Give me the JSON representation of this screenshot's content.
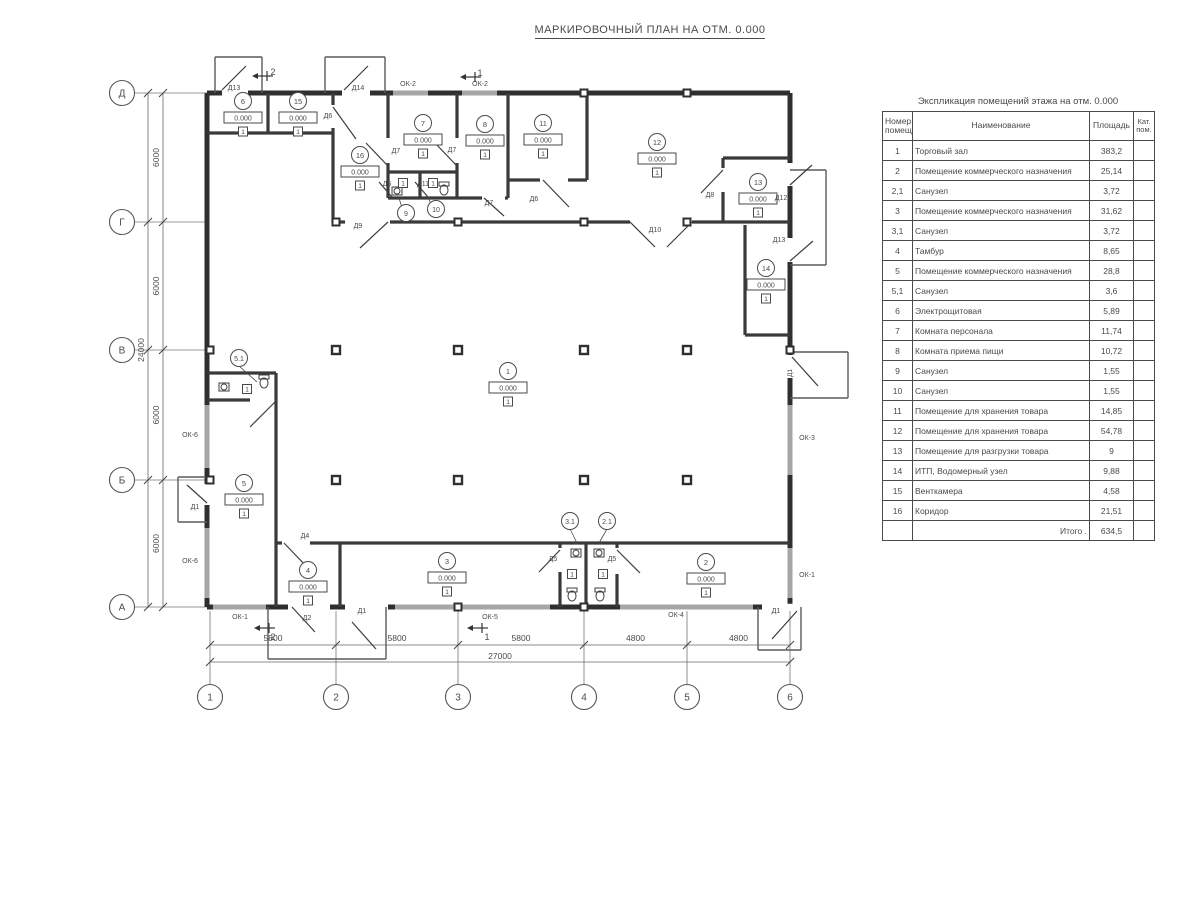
{
  "title": "МАРКИРОВОЧНЫЙ ПЛАН НА ОТМ. 0.000",
  "colors": {
    "wall": "#2f2f2f",
    "partition": "#3a3a3a",
    "window": "#a6a6a6",
    "thin": "#5a5a5a",
    "text": "#4a4a4a"
  },
  "plan": {
    "grid_rows": [
      {
        "label": "Д",
        "y": 93
      },
      {
        "label": "Г",
        "y": 222
      },
      {
        "label": "В",
        "y": 350
      },
      {
        "label": "Б",
        "y": 480
      },
      {
        "label": "А",
        "y": 607
      }
    ],
    "grid_cols": [
      {
        "label": "1",
        "x": 210
      },
      {
        "label": "2",
        "x": 336
      },
      {
        "label": "3",
        "x": 458
      },
      {
        "label": "4",
        "x": 584
      },
      {
        "label": "5",
        "x": 687
      },
      {
        "label": "6",
        "x": 790
      }
    ],
    "dim_left_segments": [
      "6000",
      "6000",
      "6000",
      "6000"
    ],
    "dim_left_total": "24000",
    "dim_bottom_segments": [
      "5800",
      "5800",
      "5800",
      "4800",
      "4800"
    ],
    "dim_bottom_total": "27000",
    "rooms": [
      {
        "num": "1",
        "x": 508,
        "y": 371,
        "elev": "0.000",
        "floor": "1"
      },
      {
        "num": "2",
        "x": 706,
        "y": 562,
        "elev": "0.000",
        "floor": "1"
      },
      {
        "num": "3",
        "x": 447,
        "y": 561,
        "elev": "0.000",
        "floor": "1"
      },
      {
        "num": "4",
        "x": 308,
        "y": 570,
        "elev": "0.000",
        "floor": "1"
      },
      {
        "num": "5",
        "x": 244,
        "y": 483,
        "elev": "0.000",
        "floor": "1"
      },
      {
        "num": "6",
        "x": 243,
        "y": 101,
        "elev": "0.000",
        "floor": "1"
      },
      {
        "num": "7",
        "x": 423,
        "y": 123,
        "elev": "0.000",
        "floor": "1"
      },
      {
        "num": "8",
        "x": 485,
        "y": 124,
        "elev": "0.000",
        "floor": "1"
      },
      {
        "num": "11",
        "x": 543,
        "y": 123,
        "elev": "0.000",
        "floor": "1"
      },
      {
        "num": "12",
        "x": 657,
        "y": 142,
        "elev": "0.000",
        "floor": "1"
      },
      {
        "num": "13",
        "x": 758,
        "y": 182,
        "elev": "0.000",
        "floor": "1"
      },
      {
        "num": "14",
        "x": 766,
        "y": 268,
        "elev": "0.000",
        "floor": "1"
      },
      {
        "num": "15",
        "x": 298,
        "y": 101,
        "elev": "0.000",
        "floor": "1"
      },
      {
        "num": "16",
        "x": 360,
        "y": 155,
        "elev": "0.000",
        "floor": "1"
      }
    ],
    "small_rooms": [
      {
        "num": "5.1",
        "x": 239,
        "y": 358,
        "lx": 257,
        "ly": 382,
        "bx": 247,
        "by": 389,
        "floor": "1"
      },
      {
        "num": "9",
        "x": 406,
        "y": 213,
        "lx": 399,
        "ly": 198,
        "bx": 403,
        "by": 183,
        "floor": "1"
      },
      {
        "num": "10",
        "x": 436,
        "y": 209,
        "lx": 428,
        "ly": 197,
        "bx": 433,
        "by": 183,
        "floor": "1"
      },
      {
        "num": "3.1",
        "x": 570,
        "y": 521,
        "lx": 577,
        "ly": 543,
        "bx": 572,
        "by": 574,
        "floor": "1"
      },
      {
        "num": "2.1",
        "x": 607,
        "y": 521,
        "lx": 599,
        "ly": 543,
        "bx": 603,
        "by": 574,
        "floor": "1"
      }
    ],
    "door_labels": [
      {
        "t": "Д13",
        "x": 234,
        "y": 90
      },
      {
        "t": "Д14",
        "x": 358,
        "y": 90
      },
      {
        "t": "Д6",
        "x": 328,
        "y": 118
      },
      {
        "t": "Д7",
        "x": 396,
        "y": 153
      },
      {
        "t": "Д7",
        "x": 452,
        "y": 152
      },
      {
        "t": "Д5",
        "x": 387,
        "y": 186
      },
      {
        "t": "Д11",
        "x": 423,
        "y": 186
      },
      {
        "t": "Д7",
        "x": 489,
        "y": 205
      },
      {
        "t": "Д6",
        "x": 534,
        "y": 201
      },
      {
        "t": "Д9",
        "x": 358,
        "y": 228
      },
      {
        "t": "Д10",
        "x": 655,
        "y": 232
      },
      {
        "t": "Д8",
        "x": 710,
        "y": 197
      },
      {
        "t": "Д12",
        "x": 781,
        "y": 200
      },
      {
        "t": "Д13",
        "x": 779,
        "y": 242
      },
      {
        "t": "Д4",
        "x": 305,
        "y": 538
      },
      {
        "t": "Д2",
        "x": 307,
        "y": 620
      },
      {
        "t": "Д1",
        "x": 362,
        "y": 613
      },
      {
        "t": "Д5",
        "x": 553,
        "y": 561
      },
      {
        "t": "Д5",
        "x": 612,
        "y": 561
      },
      {
        "t": "Д1",
        "x": 776,
        "y": 613
      },
      {
        "t": "Д1",
        "x": 195,
        "y": 509
      }
    ],
    "door_labels_rotated": [
      {
        "t": "Д1",
        "x": 792,
        "y": 373
      }
    ],
    "window_labels": [
      {
        "t": "ОК-2",
        "x": 408,
        "y": 86
      },
      {
        "t": "ОК-2",
        "x": 480,
        "y": 86
      },
      {
        "t": "ОК-6",
        "x": 190,
        "y": 437
      },
      {
        "t": "ОК-6",
        "x": 190,
        "y": 563
      },
      {
        "t": "ОК-3",
        "x": 807,
        "y": 440
      },
      {
        "t": "ОК-1",
        "x": 807,
        "y": 577
      },
      {
        "t": "ОК-1",
        "x": 240,
        "y": 619
      },
      {
        "t": "ОК-5",
        "x": 490,
        "y": 619
      },
      {
        "t": "ОК-4",
        "x": 676,
        "y": 617
      }
    ],
    "section_marks": [
      {
        "n": "2",
        "x": 258,
        "y": 76,
        "nx": 273,
        "ny": 72
      },
      {
        "n": "1",
        "x": 466,
        "y": 77,
        "nx": 480,
        "ny": 73
      },
      {
        "n": "2",
        "x": 260,
        "y": 628,
        "nx": 273,
        "ny": 637
      },
      {
        "n": "1",
        "x": 473,
        "y": 628,
        "nx": 487,
        "ny": 637
      }
    ]
  },
  "table": {
    "title": "Экспликация помещений этажа на отм. 0.000",
    "headers": [
      "Номер помещ.",
      "Наименование",
      "Площадь",
      "Кат. пом."
    ],
    "rows": [
      [
        "1",
        "Торговый зал",
        "383,2",
        ""
      ],
      [
        "2",
        "Помещение коммерческого назначения",
        "25,14",
        ""
      ],
      [
        "2,1",
        "Санузел",
        "3,72",
        ""
      ],
      [
        "3",
        "Помещение коммерческого назначения",
        "31,62",
        ""
      ],
      [
        "3,1",
        "Санузел",
        "3,72",
        ""
      ],
      [
        "4",
        "Тамбур",
        "8,65",
        ""
      ],
      [
        "5",
        "Помещение коммерческого назначения",
        "28,8",
        ""
      ],
      [
        "5,1",
        "Санузел",
        "3,6",
        ""
      ],
      [
        "6",
        "Электрощитовая",
        "5,89",
        ""
      ],
      [
        "7",
        "Комната персонала",
        "11,74",
        ""
      ],
      [
        "8",
        "Комната приема пищи",
        "10,72",
        ""
      ],
      [
        "9",
        "Санузел",
        "1,55",
        ""
      ],
      [
        "10",
        "Санузел",
        "1,55",
        ""
      ],
      [
        "11",
        "Помещение для хранения товара",
        "14,85",
        ""
      ],
      [
        "12",
        "Помещение для хранения товара",
        "54,78",
        ""
      ],
      [
        "13",
        "Помещение для разгрузки товара",
        "9",
        ""
      ],
      [
        "14",
        "ИТП, Водомерный узел",
        "9,88",
        ""
      ],
      [
        "15",
        "Венткамера",
        "4,58",
        ""
      ],
      [
        "16",
        "Коридор",
        "21,51",
        ""
      ]
    ],
    "total_label": "Итого .",
    "total_value": "634,5"
  }
}
